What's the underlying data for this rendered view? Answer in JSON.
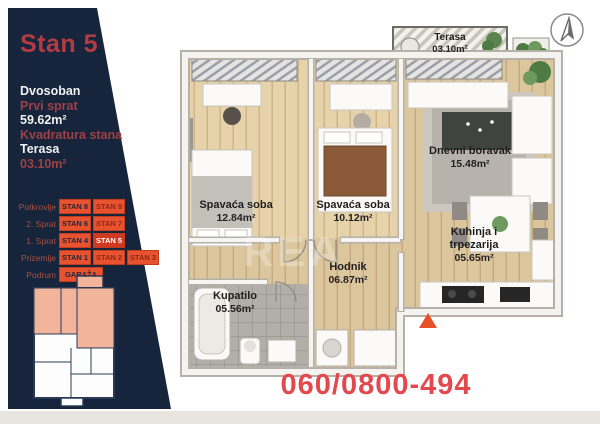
{
  "sidebar": {
    "title": "Stan 5",
    "info": [
      {
        "text": "Dvosoban",
        "tone": "white"
      },
      {
        "text": "Prvi sprat",
        "tone": "red"
      },
      {
        "text": "59.62m²",
        "tone": "white"
      },
      {
        "text": "Kvadratura stana",
        "tone": "red"
      },
      {
        "text": "Terasa",
        "tone": "white"
      },
      {
        "text": "03.10m²",
        "tone": "red"
      }
    ],
    "floors": [
      {
        "label": "Potkrovlje",
        "units": [
          {
            "name": "STAN 8"
          },
          {
            "name": "STAN 9"
          }
        ]
      },
      {
        "label": "2. Sprat",
        "units": [
          {
            "name": "STAN 6"
          },
          {
            "name": "STAN 7"
          }
        ]
      },
      {
        "label": "1. Sprat",
        "units": [
          {
            "name": "STAN 4"
          },
          {
            "name": "STAN 5"
          }
        ]
      },
      {
        "label": "Prizemlje",
        "units": [
          {
            "name": "STAN 1"
          },
          {
            "name": "STAN 2"
          },
          {
            "name": "STAN 3"
          }
        ]
      },
      {
        "label": "Podrum",
        "units": [
          {
            "name": "GARAŽA"
          }
        ]
      }
    ]
  },
  "floorplan": {
    "rooms": [
      {
        "name": "Terasa",
        "area": "03.10m²"
      },
      {
        "name": "Spavaća soba",
        "area": "12.84m²"
      },
      {
        "name": "Spavaća soba",
        "area": "10.12m²"
      },
      {
        "name": "Dnevni boravak",
        "area": "15.48m²"
      },
      {
        "name": "Hodnik",
        "area": "06.87m²"
      },
      {
        "name": "Kupatilo",
        "area": "05.56m²"
      },
      {
        "name": "Kuhinja i trpezarija",
        "area": "05.65m²"
      }
    ],
    "watermark": "REA"
  },
  "footer": {
    "phone": "060/0800-494"
  },
  "colors": {
    "navy": "#16253c",
    "title_red": "#b23b44",
    "rust": "#9e4044",
    "button_orange": "#e8522e",
    "active_red": "#d13a20",
    "phone_red": "#e3484d",
    "highlight_salmon": "#f2b49a",
    "wood": "#dcc69e"
  }
}
